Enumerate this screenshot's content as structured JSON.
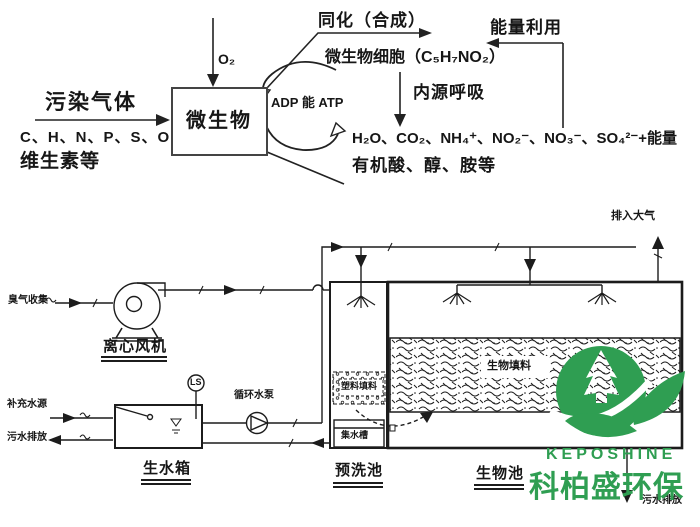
{
  "top": {
    "assimilation": "同化（合成）",
    "energy_use": "能量利用",
    "microbial_cells": "微生物细胞（C₅H₇NO₂）",
    "endogenous": "内源呼吸",
    "polluted_gas": "污染气体",
    "oxygen": "O₂",
    "microbe_box": "微生物",
    "adp_atp": "ADP 能 ATP",
    "elements": "C、H、N、P、S、O",
    "vitamins": "维生素等",
    "products": "H₂O、CO₂、NH₄⁺、NO₂⁻、NO₃⁻、SO₄²⁻+能量",
    "organics": "有机酸、醇、胺等"
  },
  "schematic": {
    "odor_inlet": "臭气收集",
    "fan_label": "离心风机",
    "ls_tag": "LS",
    "pump_label": "循环水泵",
    "makeup_water": "补充水源",
    "tank_drain": "污水排放",
    "tank_label": "生水箱",
    "prewash_packing": "塑料填料",
    "sump": "集水槽",
    "prewash_label": "预洗池",
    "bio_packing": "生物填料",
    "bio_label": "生物池",
    "to_atmosphere": "排入大气",
    "final_drain": "污水排放"
  },
  "logo": {
    "en": "KEPOSHINE",
    "zh": "科柏盛环保",
    "green": "#2f9e52"
  }
}
